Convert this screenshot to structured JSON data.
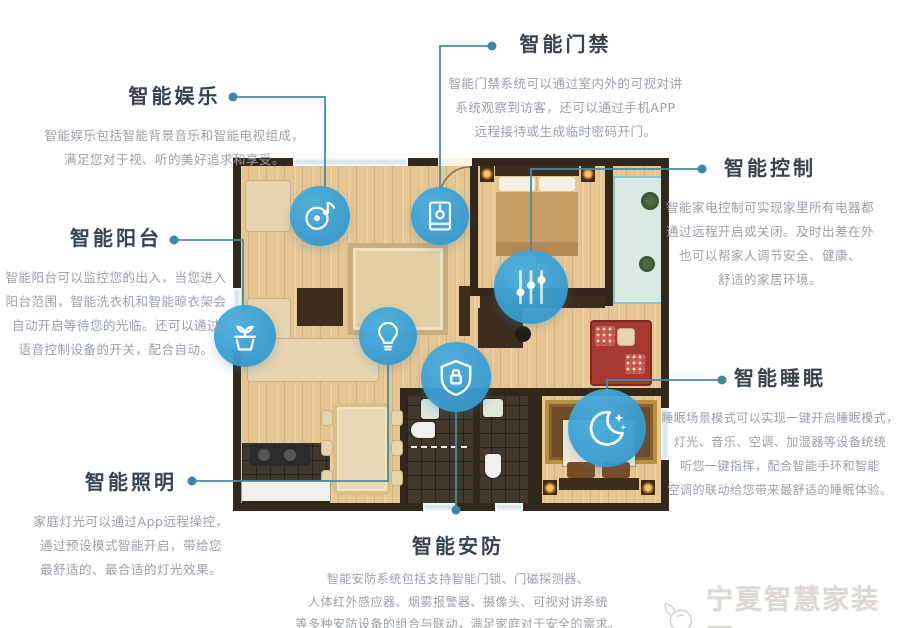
{
  "page_title": "智能家居功能户型图",
  "colors": {
    "node_blue": "#3ba3d8",
    "line_teal": "#4a8ba3",
    "title_color": "#39434e",
    "body_color": "#9aa0a6",
    "wall_dark": "#32271a",
    "floor_wood": "#e6c793"
  },
  "callouts": {
    "entertainment": {
      "title": "智能娱乐",
      "icon": "music-disc-icon",
      "lines": [
        "智能娱乐包括智能背景音乐和智能电视组成，",
        "满足您对于视、听的美好追求和享受。"
      ]
    },
    "access": {
      "title": "智能门禁",
      "icon": "door-access-icon",
      "lines": [
        "智能门禁系统可以通过室内外的可视对讲",
        "系统观察到访客，还可以通过手机APP",
        "远程接待或生成临时密码开门。"
      ]
    },
    "control": {
      "title": "智能控制",
      "icon": "sliders-icon",
      "lines": [
        "智能家电控制可实现家里所有电器都",
        "通过远程开启或关闭。及时出差在外",
        "也可以帮家人调节安全、健康、",
        "舒适的家居环境。"
      ]
    },
    "balcony": {
      "title": "智能阳台",
      "icon": "plant-pot-icon",
      "lines": [
        "智能阳台可以监控您的出入，当您进入",
        "阳台范围，智能洗衣机和智能晾衣架会",
        "自动开启等待您的光临。还可以通过",
        "语音控制设备的开关，配合自动。"
      ]
    },
    "sleep": {
      "title": "智能睡眠",
      "icon": "moon-stars-icon",
      "lines": [
        "睡眠场景模式可以实现一键开启睡眠模式，",
        "灯光、音乐、空调、加湿器等设备统统",
        "听您一键指挥，配合智能手环和智能",
        "空调的联动给您带来最舒适的睡眠体验。"
      ]
    },
    "lighting": {
      "title": "智能照明",
      "icon": "light-bulb-icon",
      "lines": [
        "家庭灯光可以通过App远程操控，",
        "通过预设模式智能开启，带给您",
        "最舒适的、最合适的灯光效果。"
      ]
    },
    "security": {
      "title": "智能安防",
      "icon": "shield-lock-icon",
      "lines": [
        "智能安防系统包括支持智能门锁、门磁探测器、",
        "人体红外感应器、烟雾报警器、摄像头、可视对讲系统",
        "等多种安防设备的组合与联动，满足家庭对于安全的需求。"
      ]
    }
  },
  "watermark": {
    "text": "宁夏智慧家装网"
  }
}
